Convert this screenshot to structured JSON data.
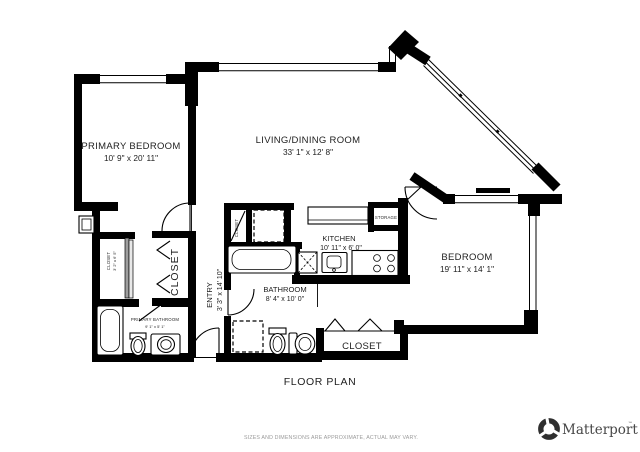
{
  "footer": {
    "title": "FLOOR PLAN",
    "disclaimer": "SIZES AND DIMENSIONS ARE APPROXIMATE, ACTUAL MAY VARY."
  },
  "branding": {
    "name": "Matterport",
    "trademark": "™",
    "logo_icon": "matterport-pinwheel-icon"
  },
  "rooms": {
    "primary_bedroom": {
      "name": "PRIMARY BEDROOM",
      "dims": "10' 9\" x 20' 11\""
    },
    "living_dining": {
      "name": "LIVING/DINING ROOM",
      "dims": "33' 1\" x 12' 8\""
    },
    "kitchen": {
      "name": "KITCHEN",
      "dims": "10' 11\" x 6' 0\""
    },
    "bedroom": {
      "name": "BEDROOM",
      "dims": "19' 11\" x 14' 1\""
    },
    "bathroom": {
      "name": "BATHROOM",
      "dims": "8' 4\" x 10' 0\""
    },
    "entry": {
      "name": "ENTRY",
      "dims": "3' 3\" x 14' 10\""
    },
    "primary_bathroom": {
      "name": "PRIMARY BATHROOM",
      "dims": "9' 1\" x 5' 1\""
    },
    "primary_closet": {
      "name": "CLOSET",
      "dims": "3' 2\" x 6' 5\""
    },
    "hall_closet": {
      "name": "CLOSET"
    },
    "utility_closet": {
      "name": "CLOSET"
    },
    "bedroom_closet": {
      "name": "CLOSET"
    },
    "storage": {
      "name": "STORAGE"
    }
  },
  "colors": {
    "walls": "#000000",
    "labels": "#1e1e1e",
    "disclaimer_text": "#9b9b9b",
    "brand_text": "#474747"
  }
}
